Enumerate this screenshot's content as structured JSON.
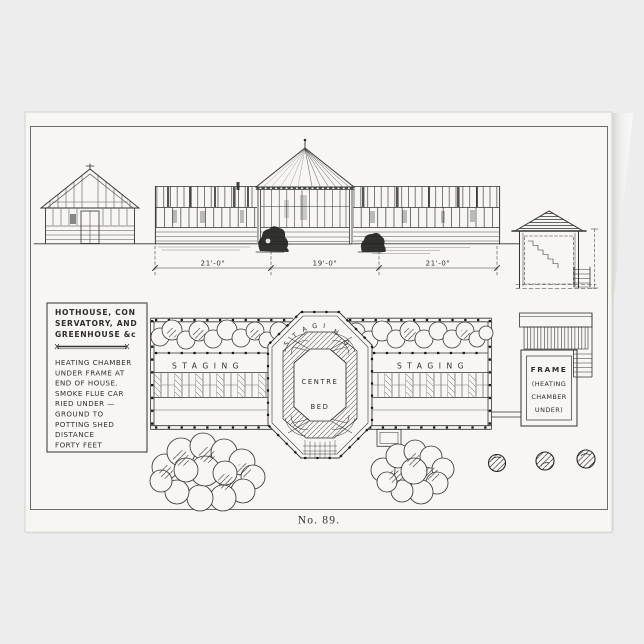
{
  "colors": {
    "background": "#ededed",
    "card": "#f7f6f3",
    "ink": "#2c2c2c"
  },
  "card": {
    "caption": "No. 89."
  },
  "elevation": {
    "dimensions": [
      "21'-0\"",
      "19'-0\"",
      "21'-0\""
    ]
  },
  "note_box": {
    "title_lines": [
      "HOTHOUSE, CON",
      "SERVATORY, AND",
      "GREENHOUSE &c"
    ],
    "body_lines": [
      "HEATING CHAMBER",
      "UNDER FRAME AT",
      "END OF HOUSE.",
      "SMOKE FLUE CAR",
      "RIED UNDER —",
      "GROUND TO",
      "POTTING SHED",
      "DISTANCE",
      "FORTY FEET"
    ]
  },
  "plan": {
    "left_wing_label": "STAGING",
    "right_wing_label": "STAGING",
    "octagon_arc_letters": [
      "S",
      "T",
      "A",
      "G",
      "I",
      "N",
      "G"
    ],
    "centre_bed_lines": [
      "CENTRE",
      "BED"
    ],
    "frame_box_lines": [
      "FRAME",
      "(HEATING",
      "CHAMBER",
      "UNDER)"
    ]
  }
}
